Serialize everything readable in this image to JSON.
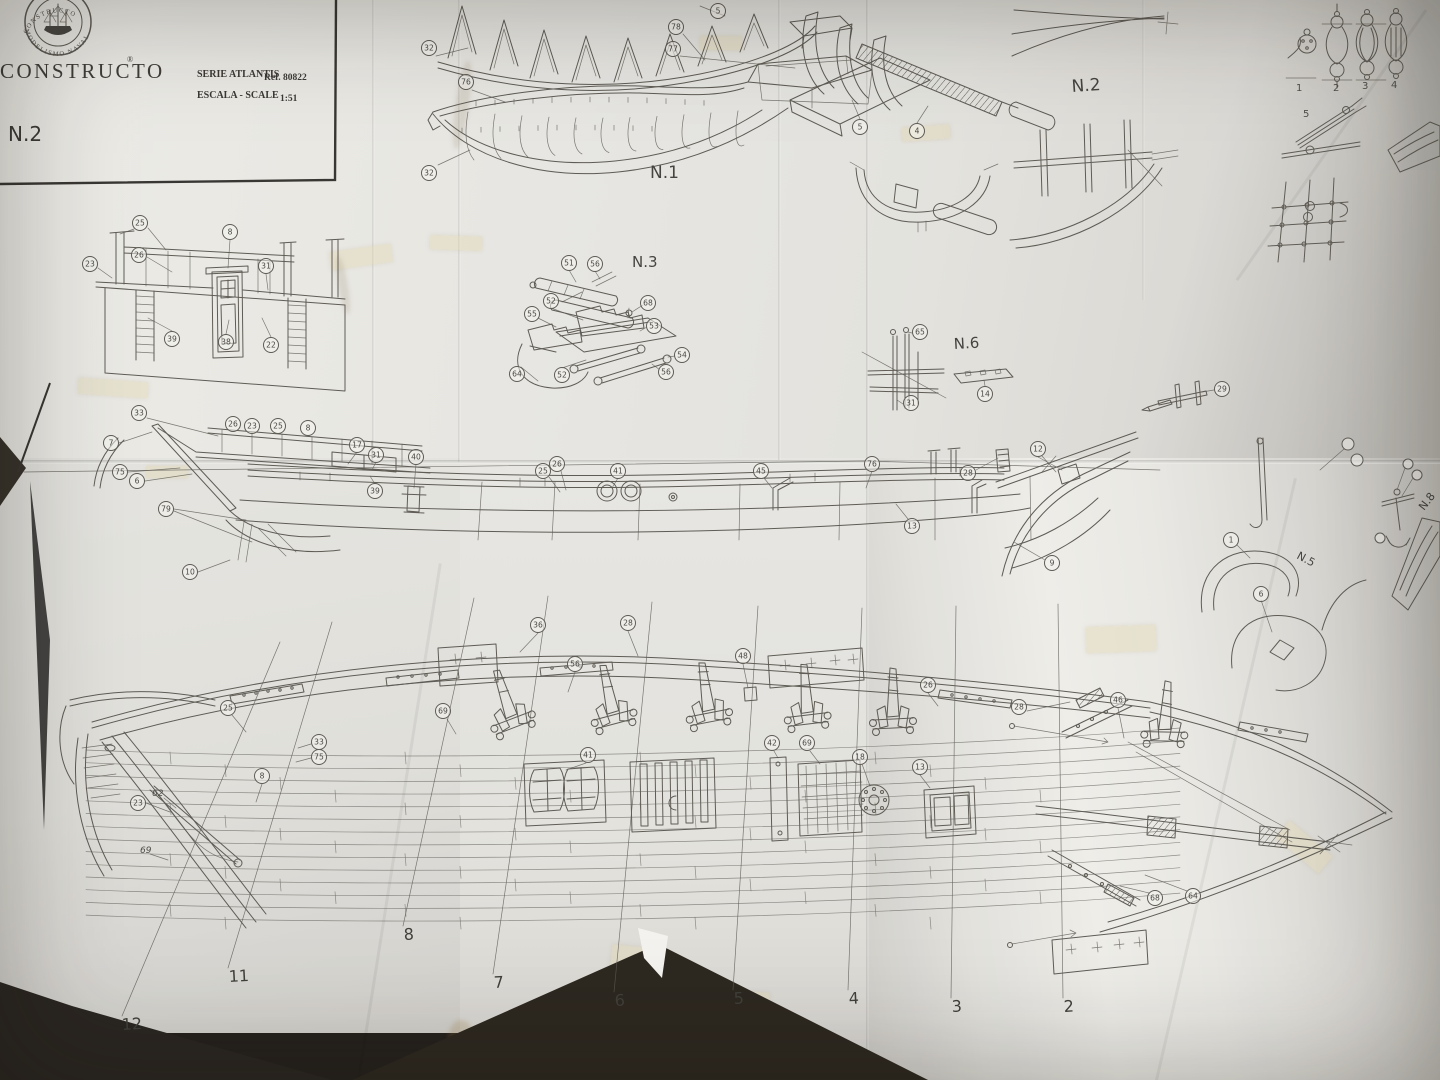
{
  "colors": {
    "paper": "#e7e6e2",
    "paper_shadow": "#cfcdc9",
    "line": "#55524c",
    "ink": "#2d2b27",
    "background": "#171310",
    "tape": "#e2d6ac"
  },
  "title_block": {
    "brand": "CONSTRUCTO",
    "registered_mark": "®",
    "stamp_text_top": "CONSTRUCTO",
    "stamp_text_bottom": "MODELISMO NAVAL",
    "series_label": "SERIE ATLANTIS",
    "ref_label": "Ref. 80822",
    "scale_label": "ESCALA - SCALE",
    "scale_value": "1:51",
    "sheet_number": "N.2"
  },
  "section_labels": [
    {
      "text": "N.1",
      "x": 650,
      "y": 178,
      "size": 17,
      "rot": 0
    },
    {
      "text": "N.3",
      "x": 632,
      "y": 267,
      "size": 15,
      "rot": 0
    },
    {
      "text": "N.2",
      "x": 1072,
      "y": 92,
      "size": 17,
      "rot": -4
    },
    {
      "text": "N.6",
      "x": 954,
      "y": 349,
      "size": 15,
      "rot": -3
    },
    {
      "text": "N.5",
      "x": 1296,
      "y": 558,
      "size": 11,
      "rot": 28
    },
    {
      "text": "N.8",
      "x": 1424,
      "y": 511,
      "size": 11,
      "rot": -52
    }
  ],
  "callouts": [
    {
      "n": "32",
      "x": 429,
      "y": 48
    },
    {
      "n": "78",
      "x": 676,
      "y": 27
    },
    {
      "n": "5",
      "x": 718,
      "y": 11
    },
    {
      "n": "77",
      "x": 673,
      "y": 49
    },
    {
      "n": "76",
      "x": 466,
      "y": 82
    },
    {
      "n": "32",
      "x": 429,
      "y": 173
    },
    {
      "n": "51",
      "x": 569,
      "y": 263
    },
    {
      "n": "56",
      "x": 595,
      "y": 264
    },
    {
      "n": "68",
      "x": 648,
      "y": 303
    },
    {
      "n": "52",
      "x": 551,
      "y": 301
    },
    {
      "n": "55",
      "x": 532,
      "y": 314
    },
    {
      "n": "53",
      "x": 654,
      "y": 326
    },
    {
      "n": "64",
      "x": 517,
      "y": 374
    },
    {
      "n": "52",
      "x": 562,
      "y": 375
    },
    {
      "n": "54",
      "x": 682,
      "y": 355
    },
    {
      "n": "56",
      "x": 666,
      "y": 372
    },
    {
      "n": "5",
      "x": 860,
      "y": 127
    },
    {
      "n": "4",
      "x": 917,
      "y": 131
    },
    {
      "n": "25",
      "x": 140,
      "y": 223
    },
    {
      "n": "26",
      "x": 139,
      "y": 255
    },
    {
      "n": "23",
      "x": 90,
      "y": 264
    },
    {
      "n": "8",
      "x": 230,
      "y": 232
    },
    {
      "n": "31",
      "x": 266,
      "y": 266
    },
    {
      "n": "39",
      "x": 172,
      "y": 339
    },
    {
      "n": "38",
      "x": 226,
      "y": 342
    },
    {
      "n": "22",
      "x": 271,
      "y": 345
    },
    {
      "n": "65",
      "x": 920,
      "y": 332
    },
    {
      "n": "31",
      "x": 911,
      "y": 403
    },
    {
      "n": "14",
      "x": 985,
      "y": 394
    },
    {
      "n": "29",
      "x": 1222,
      "y": 389
    },
    {
      "n": "33",
      "x": 139,
      "y": 413
    },
    {
      "n": "7",
      "x": 111,
      "y": 443
    },
    {
      "n": "26",
      "x": 233,
      "y": 424
    },
    {
      "n": "23",
      "x": 252,
      "y": 426
    },
    {
      "n": "25",
      "x": 278,
      "y": 426
    },
    {
      "n": "8",
      "x": 308,
      "y": 428
    },
    {
      "n": "17",
      "x": 357,
      "y": 445
    },
    {
      "n": "31",
      "x": 376,
      "y": 455
    },
    {
      "n": "40",
      "x": 416,
      "y": 457
    },
    {
      "n": "75",
      "x": 120,
      "y": 472
    },
    {
      "n": "6",
      "x": 137,
      "y": 481
    },
    {
      "n": "79",
      "x": 166,
      "y": 509
    },
    {
      "n": "39",
      "x": 375,
      "y": 491
    },
    {
      "n": "10",
      "x": 190,
      "y": 572
    },
    {
      "n": "25",
      "x": 543,
      "y": 471
    },
    {
      "n": "26",
      "x": 557,
      "y": 464
    },
    {
      "n": "41",
      "x": 618,
      "y": 471
    },
    {
      "n": "45",
      "x": 761,
      "y": 471
    },
    {
      "n": "76",
      "x": 872,
      "y": 464
    },
    {
      "n": "12",
      "x": 1038,
      "y": 449
    },
    {
      "n": "28",
      "x": 968,
      "y": 473
    },
    {
      "n": "13",
      "x": 912,
      "y": 526
    },
    {
      "n": "9",
      "x": 1052,
      "y": 563
    },
    {
      "n": "1",
      "x": 1231,
      "y": 540
    },
    {
      "n": "6",
      "x": 1261,
      "y": 594
    },
    {
      "n": "36",
      "x": 538,
      "y": 625
    },
    {
      "n": "28",
      "x": 628,
      "y": 623
    },
    {
      "n": "56",
      "x": 575,
      "y": 664
    },
    {
      "n": "48",
      "x": 743,
      "y": 656
    },
    {
      "n": "26",
      "x": 928,
      "y": 685
    },
    {
      "n": "69",
      "x": 443,
      "y": 711
    },
    {
      "n": "41",
      "x": 588,
      "y": 755
    },
    {
      "n": "42",
      "x": 772,
      "y": 743
    },
    {
      "n": "69",
      "x": 807,
      "y": 743
    },
    {
      "n": "18",
      "x": 860,
      "y": 757
    },
    {
      "n": "13",
      "x": 920,
      "y": 767
    },
    {
      "n": "25",
      "x": 228,
      "y": 708
    },
    {
      "n": "8",
      "x": 262,
      "y": 776
    },
    {
      "n": "23",
      "x": 138,
      "y": 803
    },
    {
      "n": "33",
      "x": 319,
      "y": 742
    },
    {
      "n": "75",
      "x": 319,
      "y": 757
    },
    {
      "n": "28",
      "x": 1019,
      "y": 707
    },
    {
      "n": "46",
      "x": 1118,
      "y": 700
    },
    {
      "n": "68",
      "x": 1155,
      "y": 898
    },
    {
      "n": "64",
      "x": 1193,
      "y": 896
    }
  ],
  "frame_stations": [
    {
      "n": "12",
      "x": 122,
      "y": 1030
    },
    {
      "n": "11",
      "x": 229,
      "y": 982
    },
    {
      "n": "8",
      "x": 404,
      "y": 940
    },
    {
      "n": "7",
      "x": 494,
      "y": 988
    },
    {
      "n": "6",
      "x": 615,
      "y": 1006
    },
    {
      "n": "5",
      "x": 734,
      "y": 1004
    },
    {
      "n": "4",
      "x": 849,
      "y": 1004
    },
    {
      "n": "3",
      "x": 952,
      "y": 1012
    },
    {
      "n": "2",
      "x": 1064,
      "y": 1012
    }
  ],
  "rigging_steps": [
    {
      "n": "1",
      "x": 1296,
      "y": 91
    },
    {
      "n": "2",
      "x": 1333,
      "y": 91
    },
    {
      "n": "3",
      "x": 1362,
      "y": 89
    },
    {
      "n": "4",
      "x": 1391,
      "y": 88
    },
    {
      "n": "5",
      "x": 1303,
      "y": 117
    }
  ],
  "plain_numbers": [
    {
      "t": "62",
      "x": 152,
      "y": 796
    },
    {
      "t": "69",
      "x": 140,
      "y": 853
    }
  ]
}
